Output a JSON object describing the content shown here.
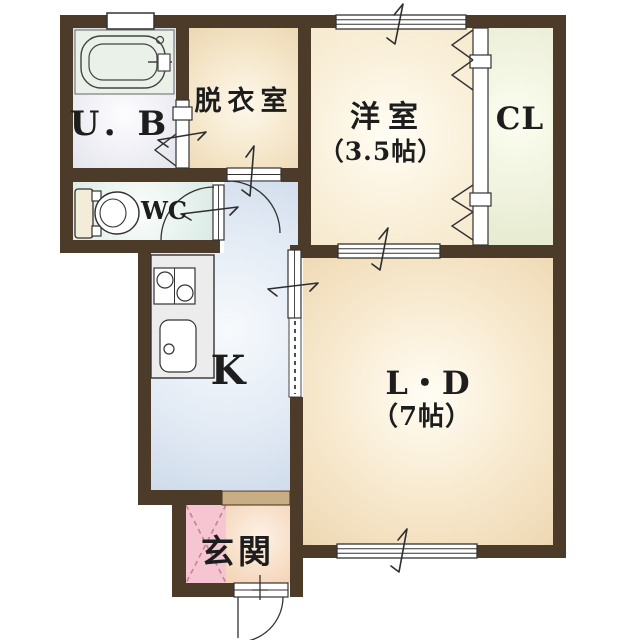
{
  "rooms": {
    "unit_bath": {
      "label": "U．B"
    },
    "dressing_room": {
      "label": "脱衣室"
    },
    "western_room": {
      "label": "洋室",
      "size": "（3.5帖）"
    },
    "closet": {
      "label": "CL"
    },
    "toilet": {
      "label": "WC"
    },
    "kitchen": {
      "label": "K"
    },
    "living_dining": {
      "label": "L・D",
      "size": "（7帖）"
    },
    "entrance": {
      "label": "玄関"
    }
  },
  "colors": {
    "wall": "#4d3b2a",
    "dressing_edge": "#e6cfa6",
    "western_edge": "#f4e6c8",
    "closet_edge": "#e7ebd1",
    "living_dining_edge": "#efd9b4",
    "kitchen_hall_edge": "#c8d6e8",
    "toilet_room_edge": "#d5e8e1",
    "unit_bath_edge": "#dddde9",
    "entrance_tile": "#f5c6d2",
    "entrance_floor_edge": "#f0c7a3",
    "step": "#c9ad85",
    "line": "#333333",
    "text": "#1d1d1d"
  }
}
